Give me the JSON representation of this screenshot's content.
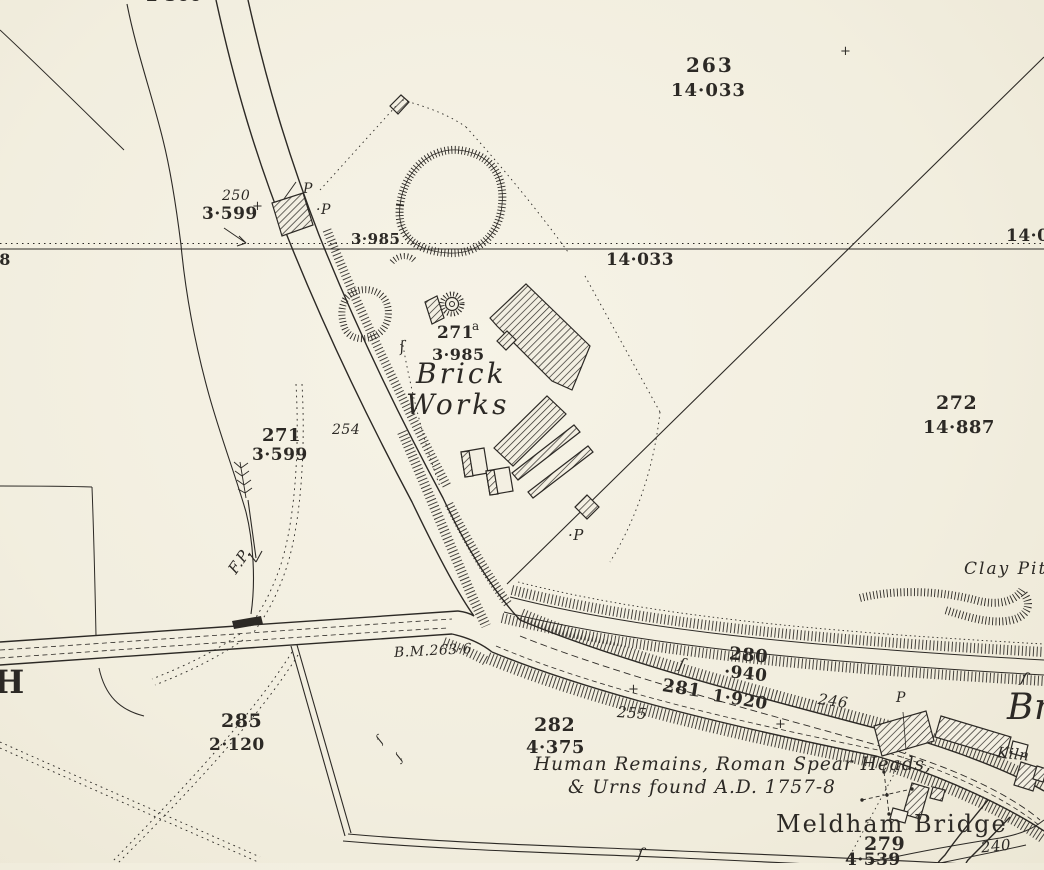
{
  "colors": {
    "paper": "#f3efe2",
    "ink": "#2c2925"
  },
  "names": {
    "brick_works_1": "Brick",
    "brick_works_2": "Works",
    "meldham_bridge": "Meldham Bridge",
    "clay_pit": "Clay Pit",
    "kiln": "Kiln",
    "edge_right_name_partial": "Br",
    "edge_left_name_partial": "H"
  },
  "annotations": {
    "antiquity_1": "Human Remains, Roman Spear Heads,",
    "antiquity_2": "& Urns found A.D. 1757-8",
    "benchmark": "B.M.263·6",
    "footpath": "F.P."
  },
  "parcels": {
    "p263": {
      "number": "263",
      "area": "14·033"
    },
    "p250": {
      "number": "250",
      "area": "3·599"
    },
    "p271a": {
      "number": "271",
      "suffix": "a",
      "area": "3·985"
    },
    "p271": {
      "number": "271",
      "area": "3·599"
    },
    "p272": {
      "number": "272",
      "area": "14·887"
    },
    "p280": {
      "number": "280",
      "area": "·940"
    },
    "p281": {
      "number": "281",
      "area": "1·920"
    },
    "p282": {
      "number": "282",
      "area": "4·375"
    },
    "p285": {
      "number": "285",
      "area": "2·120"
    },
    "p279": {
      "number": "279",
      "area": "4·539"
    }
  },
  "road_numbers": {
    "n254": "254",
    "n255": "255",
    "n246": "246",
    "n240": "240"
  },
  "spot_levels": {
    "top_3985": "3·985",
    "boundary_mid": "14·033",
    "boundary_right_partial": "14·0",
    "edge_left_partial": "268",
    "edge_top_partial": "2·366"
  },
  "letters": {
    "p": "P",
    "p_dot": "·P",
    "p_mid": "·P",
    "p_right": "P"
  },
  "symbols": {
    "brace": "ſ",
    "plus": "+"
  }
}
